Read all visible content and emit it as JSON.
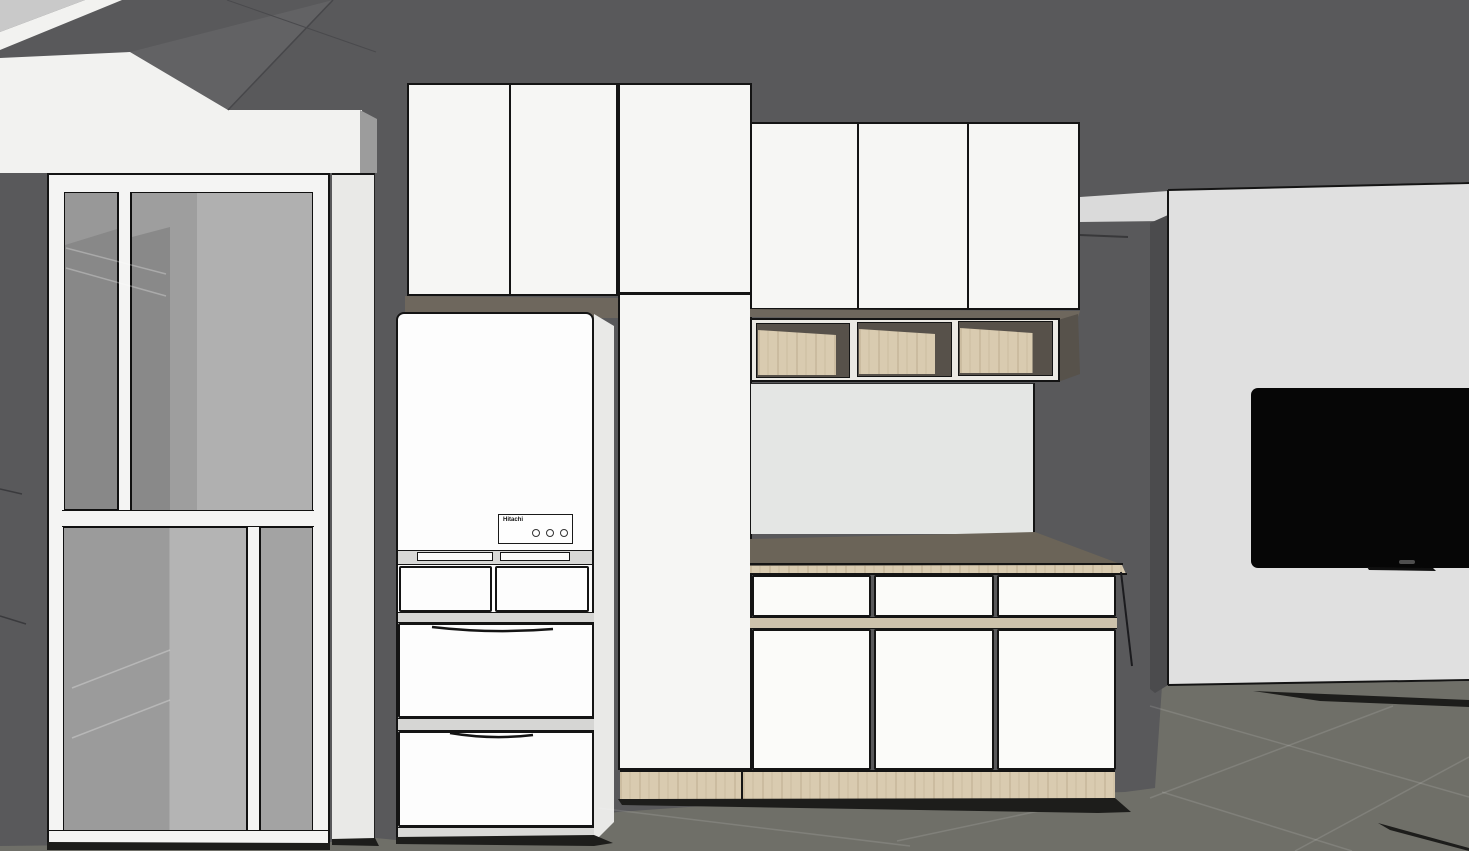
{
  "scene": {
    "type": "3d-interior-render",
    "room": "kitchen-dining",
    "labels": {
      "refrigerator_brand": "Hitachi"
    },
    "refrigerator": {
      "brand": "Hitachi",
      "control_buttons": 3,
      "top_doors": 2,
      "drawers": 4
    },
    "cabinets": {
      "left_upper_doors": 2,
      "tall_cabinet_doors": 2,
      "right_upper_doors": 3,
      "open_shelf_cubbies": 3,
      "base_drawers": 3,
      "base_doors": 3
    },
    "colors": {
      "wall": "#59595b",
      "floor": "#6f6f68",
      "ceiling_accent": "#c9c9c9",
      "soffit_white": "#f2f2f0",
      "cabinet_front": "#f6f6f4",
      "refrigerator_white": "#fdfdfd",
      "edge_line": "#141414",
      "glass_gray": "#a0a0a0",
      "wood_light": "#d9cbb0",
      "countertop_taupe": "#6b6458",
      "under_cabinet_shadow": "#6e675d",
      "shelf_interior": "#57514a",
      "backsplash": "#e4e6e4",
      "tv_wall_panel": "#e0e0e0",
      "tv_screen": "#060606"
    },
    "objects": [
      "ceiling-soffit",
      "sliding-glass-door",
      "wall-pilaster",
      "refrigerator",
      "upper-cabinets-left",
      "tall-cabinet",
      "upper-cabinets-right",
      "open-shelf-unit",
      "backsplash-panel",
      "countertop",
      "base-cabinets",
      "wood-toe-kick",
      "tv-wall-panel",
      "wall-mounted-tv",
      "tiled-floor"
    ]
  }
}
